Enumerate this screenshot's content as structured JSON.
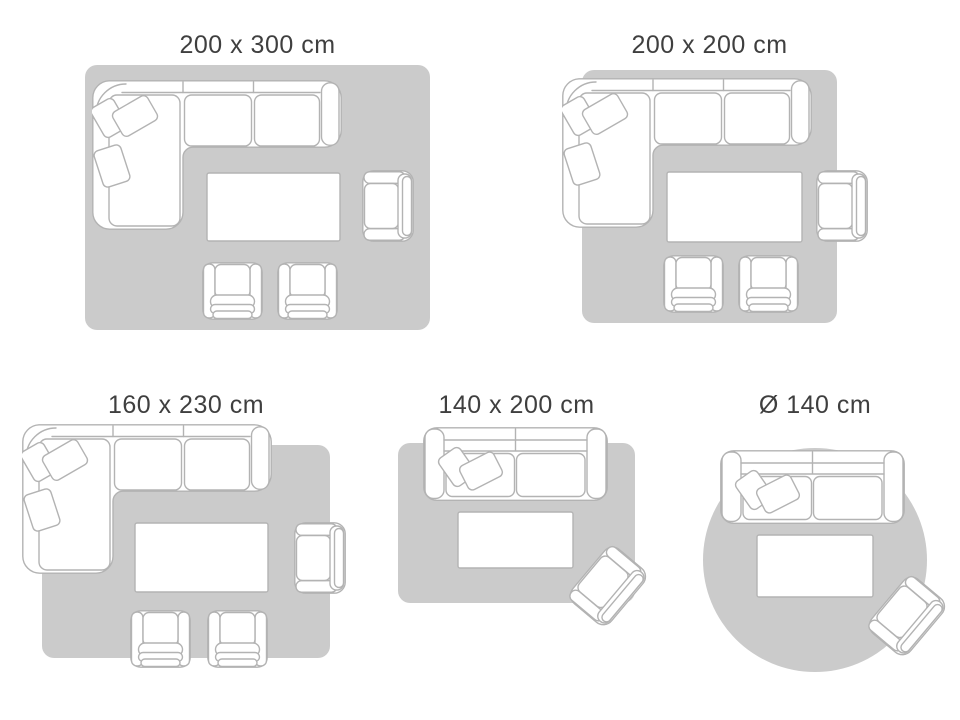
{
  "page": {
    "kind": "rug-size-guide",
    "background": "#ffffff"
  },
  "colors": {
    "rug": "#cbcbcb",
    "outline": "#b3b3b3",
    "furniture_fill": "#ffffff",
    "title_text": "#3f3f3f"
  },
  "panels": [
    {
      "id": "200x300",
      "label": "200 x 300 cm",
      "rug_shape": "rectangle",
      "furniture": [
        "corner-sofa",
        "coffee-table",
        "armchair",
        "small-armchair",
        "small-armchair"
      ]
    },
    {
      "id": "200x200",
      "label": "200 x 200 cm",
      "rug_shape": "square",
      "furniture": [
        "corner-sofa",
        "coffee-table",
        "armchair",
        "small-armchair",
        "small-armchair"
      ]
    },
    {
      "id": "160x230",
      "label": "160 x 230 cm",
      "rug_shape": "rectangle",
      "furniture": [
        "corner-sofa",
        "coffee-table",
        "armchair",
        "small-armchair",
        "small-armchair"
      ]
    },
    {
      "id": "140x200",
      "label": "140 x 200 cm",
      "rug_shape": "rectangle",
      "furniture": [
        "sofa",
        "coffee-table",
        "armchair-rotated"
      ]
    },
    {
      "id": "d140",
      "label": "Ø 140 cm",
      "rug_shape": "circle",
      "furniture": [
        "sofa",
        "coffee-table",
        "armchair-rotated"
      ]
    }
  ]
}
